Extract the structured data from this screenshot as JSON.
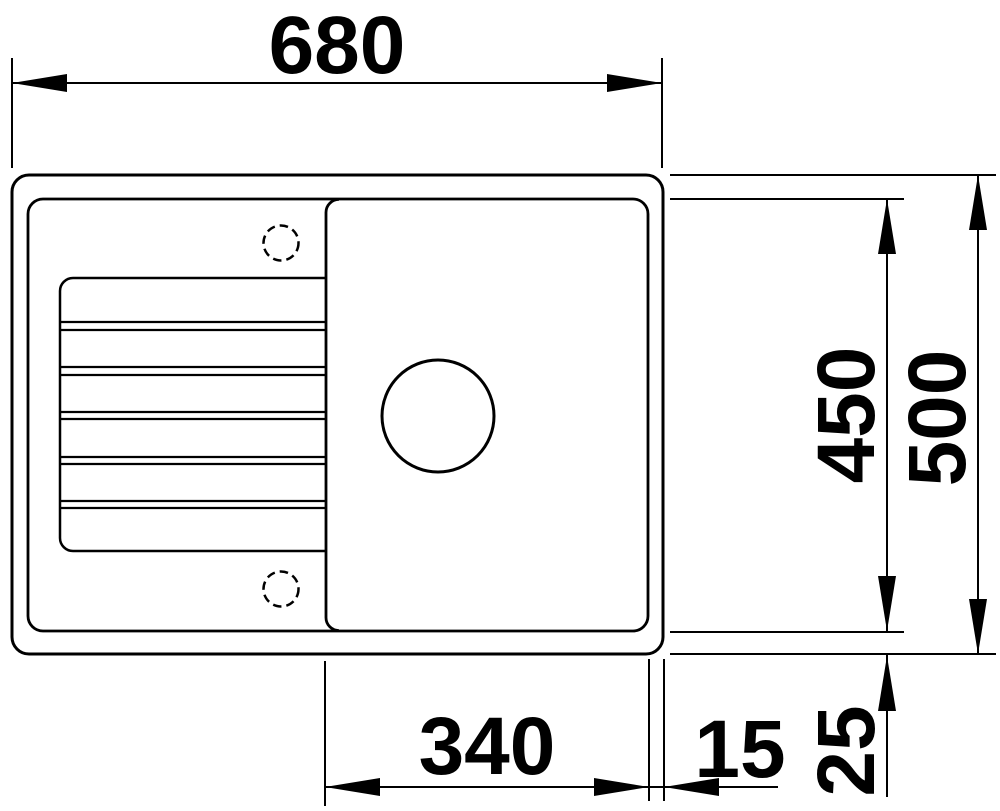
{
  "drawing": {
    "title": "Sink dimension drawing - top view",
    "background_color": "#ffffff",
    "line_color": "#000000",
    "dimensions": {
      "overall_width": "680",
      "overall_depth": "500",
      "inner_depth": "450",
      "bowl_width": "340",
      "bowl_to_edge": "15",
      "rim_offset": "25"
    }
  }
}
